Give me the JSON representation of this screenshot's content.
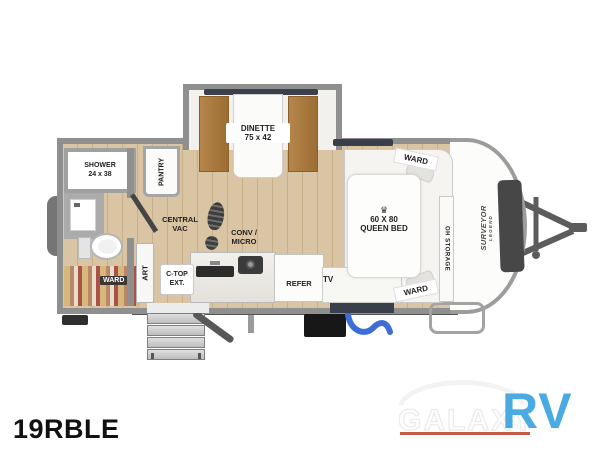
{
  "model_label": "19RBLE",
  "brand": {
    "line1": "SURVEYOR",
    "line2": "LEGEND"
  },
  "dealer_logo": {
    "word1": "GALAXY",
    "word2": "RV"
  },
  "labels": {
    "dinette": {
      "l1": "DINETTE",
      "l2": "75 x 42"
    },
    "shower": {
      "l1": "SHOWER",
      "l2": "24 x 38"
    },
    "pantry": "PANTRY",
    "central_vac": {
      "l1": "CENTRAL",
      "l2": "VAC"
    },
    "conv_micro": {
      "l1": "CONV /",
      "l2": "MICRO"
    },
    "art": "ART",
    "ctop_ext": {
      "l1": "C-TOP",
      "l2": "EXT."
    },
    "refer": "REFER",
    "tv": "TV",
    "ward_bath": "WARD",
    "ward_front_top": "WARD",
    "ward_front_bottom": "WARD",
    "oh_storage": "OH STORAGE",
    "queen_bed": {
      "crown": "♛",
      "l1": "60 X 80",
      "l2": "QUEEN BED"
    }
  },
  "colors": {
    "floor": "#d9c5a4",
    "wall_gray": "#8f8f8f",
    "cushion_brown": "#a97a3e",
    "window_dark": "#39404c",
    "logo_blue": "#4aabe2",
    "logo_red": "#c65a48"
  }
}
